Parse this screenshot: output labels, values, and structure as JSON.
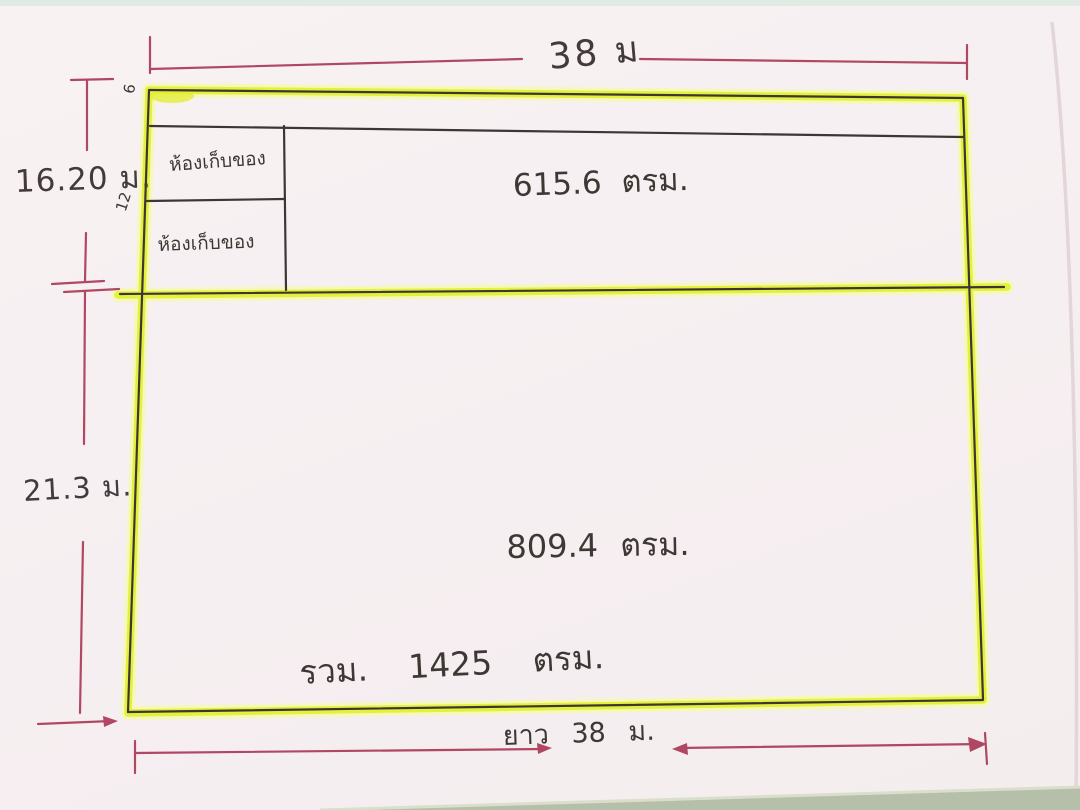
{
  "sketch": {
    "description_texts": {
      "top_width": "38 ม",
      "left_height_upper": "16.20 ม.",
      "left_height_lower": "21.3 ม.",
      "bottom_length": "ยาว 38 ม.",
      "upper_area": "615.6 ตรม.",
      "lower_area": "809.4 ตรม.",
      "total_area": "รวม. 1425 ตรม.",
      "upper_left_note": "6",
      "mid_left_note": "12"
    },
    "rooms": [
      {
        "label": "ห้องเก็บของ"
      },
      {
        "label": "ห้องเก็บของ"
      }
    ],
    "colors": {
      "paper": "#f6eff1",
      "highlighter_core": "#e3ee2d",
      "highlighter_halo": "#f4f9b0",
      "pen_black": "#3b3734",
      "dimension_red": "#b04763",
      "table_green": "#b5bfa9",
      "table_top_strip": "#dfe9e2"
    }
  }
}
